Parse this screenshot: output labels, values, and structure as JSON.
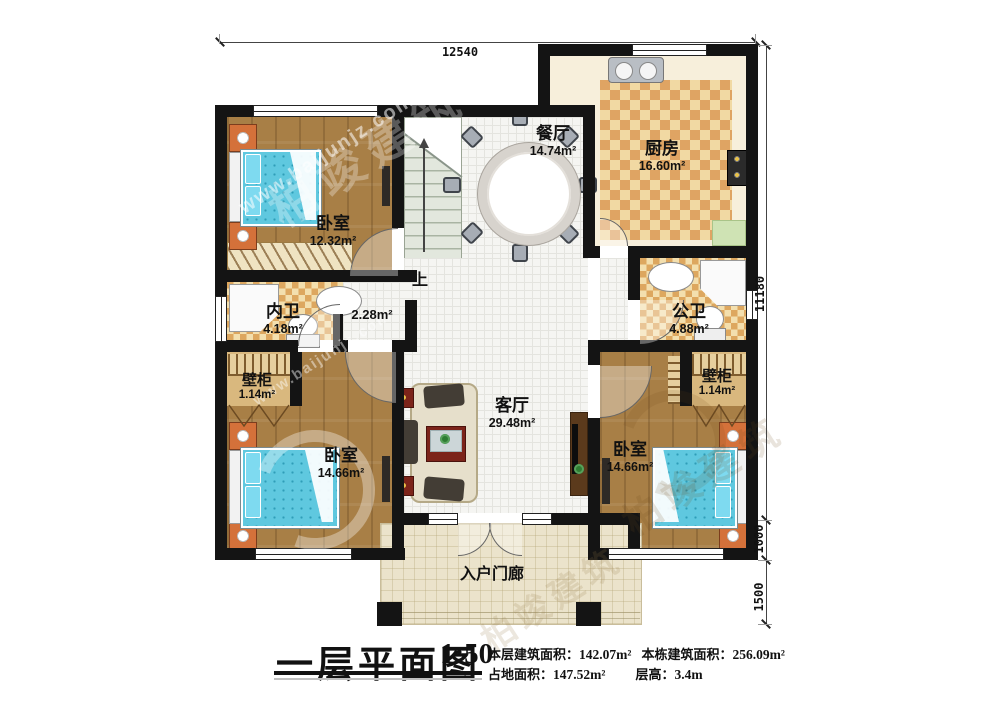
{
  "title_block": {
    "title": "一层平面图",
    "scale": "1:50",
    "stats": {
      "floor_area_label": "本层建筑面积：",
      "floor_area": "142.07m²",
      "total_area_label": "本栋建筑面积：",
      "total_area": "256.09m²",
      "footprint_label": "占地面积：",
      "footprint": "147.52m²",
      "height_label": "层高：",
      "height": "3.4m"
    }
  },
  "dimensions": {
    "top": "12540",
    "right_main": "11180",
    "right_bedroom": "1000",
    "right_porch": "1500"
  },
  "rooms": {
    "bedroom_top_left": {
      "name": "卧室",
      "area": "12.32m²"
    },
    "dining": {
      "name": "餐厅",
      "area": "14.74m²"
    },
    "kitchen": {
      "name": "厨房",
      "area": "16.60m²"
    },
    "inner_bath": {
      "name": "内卫",
      "area": "4.18m²"
    },
    "public_bath": {
      "name": "公卫",
      "area": "4.88m²"
    },
    "closet_left": {
      "name": "壁柜",
      "area": "1.14m²"
    },
    "closet_right": {
      "name": "壁柜",
      "area": "1.14m²"
    },
    "living": {
      "name": "客厅",
      "area": "29.48m²"
    },
    "bedroom_bottom_left": {
      "name": "卧室",
      "area": "14.66m²"
    },
    "bedroom_bottom_right": {
      "name": "卧室",
      "area": "14.66m²"
    },
    "porch": {
      "name": "入户门廊"
    }
  },
  "labels": {
    "stairs_up": "上",
    "hall_area": "2.28m²"
  },
  "watermark": {
    "site": "www.baijunjz.com",
    "brand": "柏竣建筑"
  },
  "colors": {
    "wall": "#141414",
    "wood_floor": "#a87f46",
    "bed_blue": "#5fc8df",
    "checker_orange": "#dfa463",
    "tile_white": "#f5f5f2",
    "porch_beige": "#ebe3cb",
    "stairs_green": "#e2e7dd",
    "accent_red": "#7c241a",
    "nightstand_orange": "#d4713a"
  }
}
